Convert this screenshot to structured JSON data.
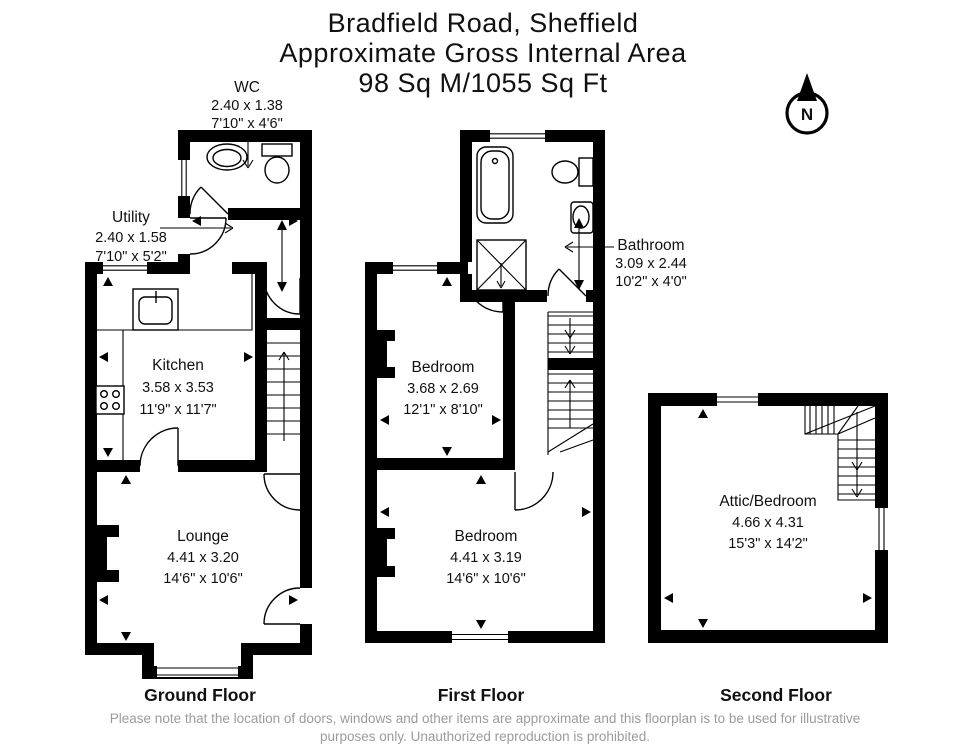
{
  "title": {
    "line1": "Bradfield Road, Sheffield",
    "line2": "Approximate Gross Internal Area",
    "line3": "98 Sq M/1055 Sq Ft"
  },
  "compass": {
    "north_label": "N"
  },
  "floors": {
    "ground": {
      "label": "Ground Floor",
      "rooms": {
        "wc": {
          "name": "WC",
          "metric": "2.40 x 1.38",
          "imperial": "7'10\" x 4'6\""
        },
        "utility": {
          "name": "Utility",
          "metric": "2.40 x 1.58",
          "imperial": "7'10\" x 5'2\""
        },
        "kitchen": {
          "name": "Kitchen",
          "metric": "3.58 x 3.53",
          "imperial": "11'9\" x 11'7\""
        },
        "lounge": {
          "name": "Lounge",
          "metric": "4.41 x 3.20",
          "imperial": "14'6\" x 10'6\""
        }
      }
    },
    "first": {
      "label": "First Floor",
      "rooms": {
        "bathroom": {
          "name": "Bathroom",
          "metric": "3.09 x 2.44",
          "imperial": "10'2\" x 4'0\""
        },
        "bedroom1": {
          "name": "Bedroom",
          "metric": "3.68 x 2.69",
          "imperial": "12'1\" x 8'10\""
        },
        "bedroom2": {
          "name": "Bedroom",
          "metric": "4.41 x 3.19",
          "imperial": "14'6\" x 10'6\""
        }
      }
    },
    "second": {
      "label": "Second Floor",
      "rooms": {
        "attic": {
          "name": "Attic/Bedroom",
          "metric": "4.66 x 4.31",
          "imperial": "15'3\" x 14'2\""
        }
      }
    }
  },
  "disclaimer": {
    "line1": "Please note that the location of doors, windows and other items are approximate and this floorplan is to be used for illustrative",
    "line2": "purposes only. Unauthorized reproduction is prohibited."
  },
  "colors": {
    "wall": "#000000",
    "disclaimer_text": "#9b9b9b",
    "background": "#ffffff"
  }
}
